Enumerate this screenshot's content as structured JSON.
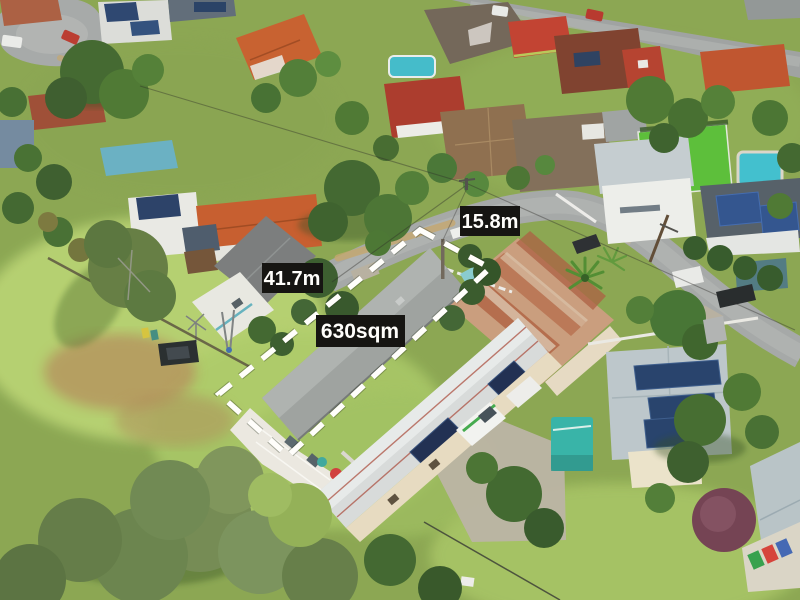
{
  "annotations": {
    "frontage_label": "15.8m",
    "side_label": "41.7m",
    "area_label": "630sqm",
    "label_background": "#0a0a0a",
    "label_text_color": "#ffffff",
    "boundary_color": "#ffffff"
  }
}
